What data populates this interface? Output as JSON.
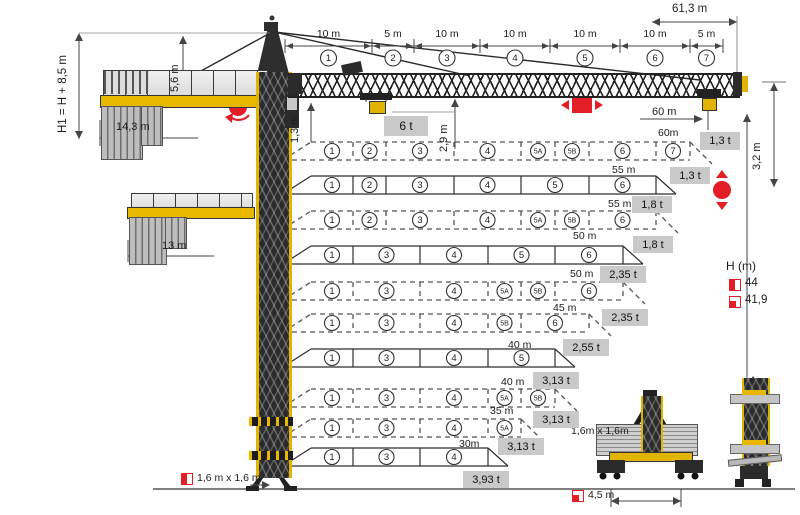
{
  "colors": {
    "crane_yellow": "#e8b800",
    "signal_red": "#E31E26",
    "load_box_gray": "#c9c9c9"
  },
  "jib": {
    "total_length": "61,3 m",
    "segments": [
      {
        "no": "1",
        "dim": "10 m"
      },
      {
        "no": "2",
        "dim": "5 m"
      },
      {
        "no": "3",
        "dim": "10 m"
      },
      {
        "no": "4",
        "dim": "10 m"
      },
      {
        "no": "5",
        "dim": "10 m"
      },
      {
        "no": "6",
        "dim": "10 m"
      },
      {
        "no": "7",
        "dim": "5 m"
      }
    ]
  },
  "elevation": {
    "hook_height_label": "H1 = H + 8,5 m",
    "tower_head_height": "5,6 m",
    "counterjib_length": "14,3 m",
    "counterjib_short_length": "13 m",
    "mast_head_section": "1,3 m",
    "hook_clearance": "2,9 m",
    "max_load": "6 t",
    "tip_radius": "60 m",
    "tip_load": "1,3 t",
    "tip_hook_band": "3,2 m",
    "mast_section_label": "1,6 m x 1,6 m"
  },
  "h_chart": {
    "title": "H (m)",
    "entries": [
      {
        "icon": "half-filled-square-icon",
        "value": "44"
      },
      {
        "icon": "corner-filled-square-icon",
        "value": "41,9"
      }
    ]
  },
  "configurations": [
    {
      "length_label": "60m",
      "tip_load": "1,3 t",
      "style": "dashed",
      "segments": [
        "1",
        "2",
        "3",
        "4",
        "5A",
        "5B",
        "6",
        "7"
      ]
    },
    {
      "length_label": "55 m",
      "tip_load": "1,8 t",
      "style": "solid",
      "segments": [
        "1",
        "2",
        "3",
        "4",
        "5",
        "6"
      ]
    },
    {
      "length_label": "55 m",
      "tip_load": "1,8 t",
      "style": "dashed",
      "segments": [
        "1",
        "2",
        "3",
        "4",
        "5A",
        "5B",
        "6"
      ]
    },
    {
      "length_label": "50 m",
      "tip_load": "2,35 t",
      "style": "solid",
      "segments": [
        "1",
        "3",
        "4",
        "5",
        "6"
      ]
    },
    {
      "length_label": "50 m",
      "tip_load": "2,35 t",
      "style": "dashed",
      "segments": [
        "1",
        "3",
        "4",
        "5A",
        "5B",
        "6"
      ]
    },
    {
      "length_label": "45 m",
      "tip_load": "2,55 t",
      "style": "dashed",
      "segments": [
        "1",
        "3",
        "4",
        "5B",
        "6"
      ]
    },
    {
      "length_label": "40 m",
      "tip_load": "3,13 t",
      "style": "solid",
      "segments": [
        "1",
        "3",
        "4",
        "5"
      ]
    },
    {
      "length_label": "40 m",
      "tip_load": "3,13 t",
      "style": "dashed",
      "segments": [
        "1",
        "3",
        "4",
        "5A",
        "5B"
      ]
    },
    {
      "length_label": "35 m",
      "tip_load": "3,13 t",
      "style": "dashed",
      "segments": [
        "1",
        "3",
        "4",
        "5A"
      ]
    },
    {
      "length_label": "30m",
      "tip_load": "3,93 t",
      "style": "solid",
      "segments": [
        "1",
        "3",
        "4"
      ]
    }
  ],
  "base_assembly": {
    "mast_section": "1,6m x 1,6m",
    "base_dimension": "4,5 m"
  },
  "motion_icons": [
    {
      "name": "slewing-icon"
    },
    {
      "name": "trolley-travel-icon"
    },
    {
      "name": "hoist-icon"
    }
  ]
}
